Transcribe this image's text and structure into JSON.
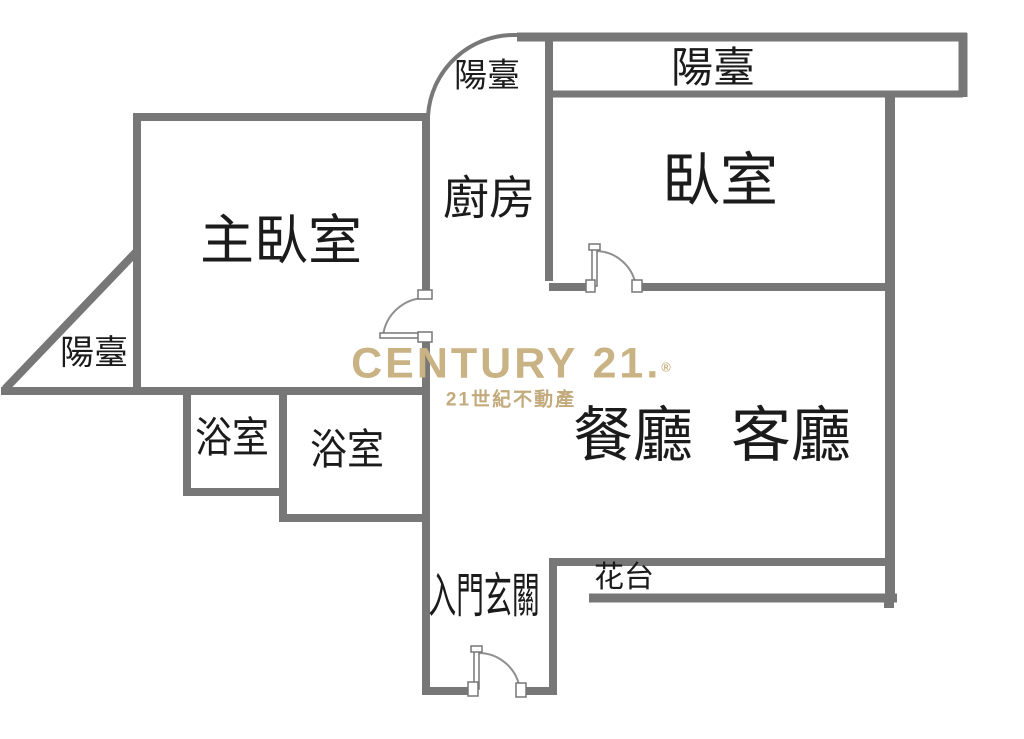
{
  "floorplan": {
    "rooms": {
      "master_bedroom": "主臥室",
      "kitchen": "廚房",
      "bedroom": "臥室",
      "bathroom_1": "浴室",
      "bathroom_2": "浴室",
      "dining": "餐廳",
      "living": "客廳",
      "foyer": "入門玄關",
      "planter": "花台",
      "balcony_kitchen": "陽臺",
      "balcony_bedroom": "陽臺",
      "balcony_master": "陽臺"
    },
    "watermark": {
      "brand": "CENTURY 21.",
      "registered": "®",
      "tagline": "21世紀不動產"
    },
    "colors": {
      "wall_gray": "#777777",
      "door_line_gray": "#8f8f8f",
      "label_black": "#1b1b1b",
      "brand_gold": "#c9b284",
      "tagline_gold": "#c3aa7c",
      "background": "#ffffff"
    }
  }
}
